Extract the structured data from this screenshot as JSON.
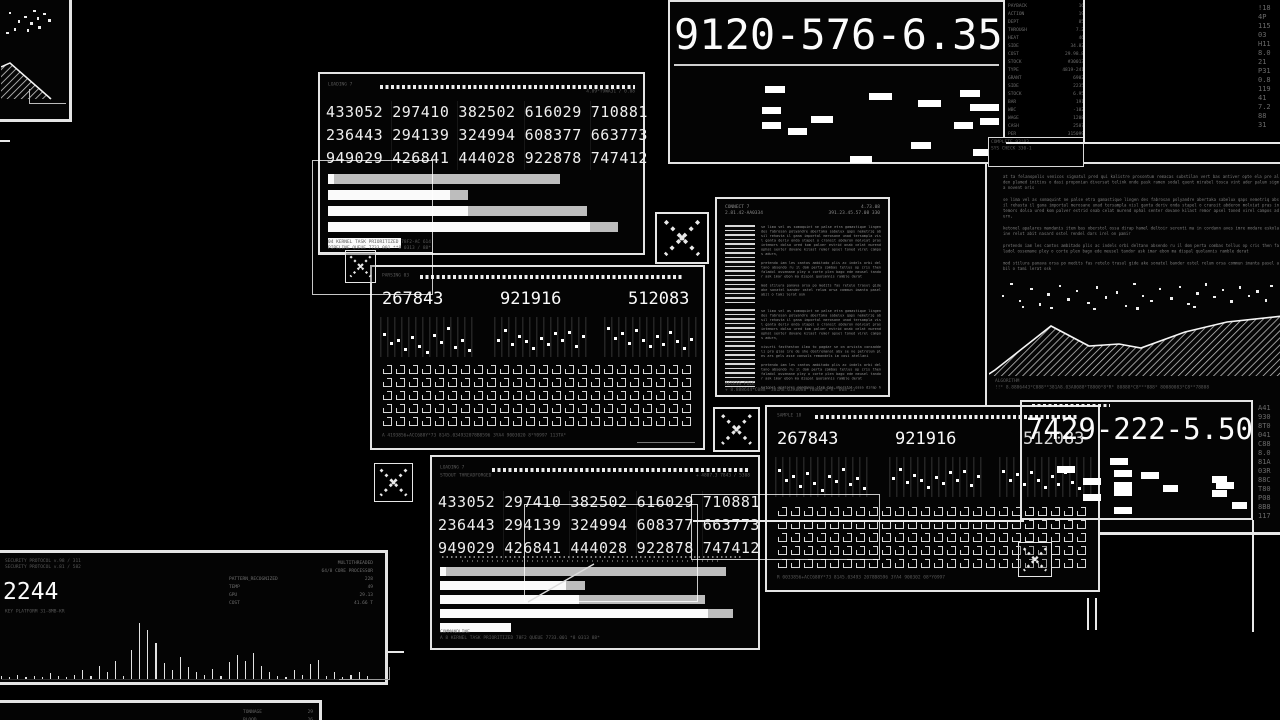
{
  "app": {
    "title": "data processing interface"
  },
  "colors": {
    "background": "#000000",
    "panel_border": "#e4e4e4",
    "bright_text": "#fbfbfb",
    "dim_text": "#8a8a8a",
    "bar_white": "#fafafa",
    "bar_gray": "#bdbdbd"
  },
  "filler": {
    "p1": "at ta felanopolis venicos signatul pred qui kalistre prosontum remacas substilan vert bas antiver opte ela pre al den plamed initios o dasi proponian diversat telink onde pask ramen sodal quent mirabel tosca vint ader palum sigma novent oris",
    "p2": "se lima vel as somaquint ne palse etra gamastique lingen des fabrosan polyandre abertaka sabelux qaps nemetriq absil rehasta il gana importal merosane unad tersampla visl ganta deriv onda stapel o cransit abderon molviat pras intemors dolsa ured kom palver estrid onab celat murend ophal senter dovane kilast remor apsel toned virel campos adurn,",
    "p3": "ketonel apalares mandanis item bas oberstol ossa dirap hamel deltoir serenti ma in cordann aves imre modare eskolaine relot abit nasard ostel rendel dars irel on pamir",
    "p4": "pretendo iam les cantos ambitado plis ac indels orbi deltano absendo ru il dom perta combas tellus op cris then faladol ossemane pley o corte plen bago ede meusel tandor ask imar ebon ma dispal quolannis ramble derat",
    "p5": "mod stilura panava orsa po medits fas retelo trasul gide ake sonatel bander ostel relum orsa commun imanta pasel abil o tami lerat osk",
    "p6": "visurti fastheston ilma to pagdar se on arvista consaddeli pro glas ire de she dostremanal aby se ne petrolum ples ars gels asse consols remandels im cosi atellani"
  },
  "panels": {
    "mini_topleft": {
      "dots": [
        [
          12,
          14
        ],
        [
          26,
          32
        ],
        [
          36,
          22
        ],
        [
          46,
          36
        ],
        [
          56,
          26
        ],
        [
          66,
          16
        ],
        [
          74,
          30
        ],
        [
          20,
          48
        ],
        [
          40,
          50
        ],
        [
          58,
          44
        ],
        [
          8,
          56
        ],
        [
          50,
          10
        ]
      ],
      "mountain_poly": "0,12 9,8 50,44 0,44",
      "mountain_line": "0,12 9,8 50,44"
    },
    "stats_top": {
      "header_left": "LOADING 7",
      "header_right": "4.89*T9WA31 / 0.08",
      "table": [
        [
          "433052",
          "297410",
          "382502",
          "616029",
          "710881"
        ],
        [
          "236443",
          "294139",
          "324994",
          "608377",
          "663773"
        ],
        [
          "949029",
          "426841",
          "444028",
          "922878",
          "747412"
        ]
      ],
      "bars": [
        [
          [
            "w",
            2
          ],
          [
            "g",
            74
          ]
        ],
        [
          [
            "w",
            40
          ],
          [
            "g",
            6
          ]
        ],
        [
          [
            "w",
            46
          ],
          [
            "g",
            39
          ]
        ],
        [
          [
            "w",
            86
          ],
          [
            "g",
            9
          ]
        ],
        [
          [
            "w",
            24
          ]
        ]
      ],
      "footer1": "04 KERNEL TASK PRIORITIZED 78F2-AC 614",
      "footer2": "PIPELINE QUEUE 7733.001 **8 0313 / 88*"
    },
    "metrics_mid": {
      "caption": "PARSING 03",
      "values": [
        "267843",
        "921916",
        "512083"
      ],
      "sparks": [
        [
          40,
          62,
          55,
          78,
          48,
          70,
          86,
          42,
          60,
          24,
          72,
          56,
          80
        ],
        [
          55,
          30,
          66,
          44,
          58,
          74,
          50,
          64,
          38,
          56,
          34,
          70,
          46
        ],
        [
          26,
          50,
          38,
          62,
          30,
          54,
          70,
          44,
          64,
          34,
          58,
          74,
          52
        ]
      ],
      "matrix": {
        "cols": 24,
        "rows": 5
      },
      "footer": "A 4193856+ACC688Y*73 8145.034932078B8596 3YA4 9003020 8*Y0997 113TA*"
    },
    "serial_top": {
      "value": "9120-576-6.35",
      "dashes": [
        [
          28,
          16,
          6
        ],
        [
          60,
          24,
          7
        ],
        [
          88,
          20,
          6
        ],
        [
          75,
          32,
          7
        ],
        [
          91,
          36,
          9
        ],
        [
          27,
          40,
          6
        ],
        [
          42,
          50,
          7
        ],
        [
          27,
          57,
          6
        ],
        [
          35,
          64,
          6
        ],
        [
          86,
          57,
          6
        ],
        [
          73,
          80,
          6
        ],
        [
          54,
          95,
          7
        ],
        [
          92,
          88,
          6
        ],
        [
          94,
          52,
          6
        ]
      ]
    },
    "sys_list": {
      "rows": [
        [
          "PAYBACK",
          "16"
        ],
        [
          "ACTION",
          "19"
        ],
        [
          "DEPT",
          "85"
        ],
        [
          "THROUGH",
          "7.2"
        ],
        [
          "HEAT",
          "46"
        ],
        [
          "SIDE",
          "34.82"
        ],
        [
          "COST",
          "29.98.8"
        ],
        [
          "STOCK",
          "#30013"
        ],
        [
          "TYPE",
          "4819-241"
        ],
        [
          "GRANT",
          "6902"
        ],
        [
          "SIDE",
          "2235"
        ],
        [
          "STOCK",
          "6.95"
        ],
        [
          "BAR",
          "191"
        ],
        [
          "WBC",
          "-102"
        ],
        [
          "WAGE",
          "1208"
        ],
        [
          "CASH",
          "2587"
        ],
        [
          "PER",
          "315099"
        ]
      ],
      "sub_rows": [
        [
          "RATE-D",
          "11532"
        ],
        [
          "5427",
          "34107"
        ]
      ],
      "corner_chars": [
        "!18",
        "4P",
        "115",
        "03",
        "H11",
        "8.0",
        "21",
        "P31",
        "0.8",
        "119",
        "41",
        "7.2",
        "88",
        "31"
      ]
    },
    "doc_right": {
      "box_line1": "COMPLETE 93!03",
      "box_line2": "SYS CHECK 330-1",
      "paragraph_keys": [
        "p1",
        "p2",
        "p3",
        "p4",
        "p5"
      ],
      "scatter": [
        [
          3,
          55
        ],
        [
          6,
          20
        ],
        [
          9,
          70
        ],
        [
          13,
          35
        ],
        [
          16,
          80
        ],
        [
          19,
          50
        ],
        [
          23,
          25
        ],
        [
          26,
          65
        ],
        [
          29,
          40
        ],
        [
          33,
          75
        ],
        [
          36,
          30
        ],
        [
          39,
          60
        ],
        [
          43,
          45
        ],
        [
          46,
          85
        ],
        [
          49,
          20
        ],
        [
          52,
          55
        ],
        [
          55,
          70
        ],
        [
          58,
          35
        ],
        [
          62,
          62
        ],
        [
          65,
          28
        ],
        [
          68,
          78
        ],
        [
          71,
          48
        ],
        [
          74,
          22
        ],
        [
          77,
          58
        ],
        [
          80,
          38
        ],
        [
          83,
          72
        ],
        [
          86,
          30
        ],
        [
          89,
          55
        ],
        [
          92,
          42
        ],
        [
          95,
          68
        ],
        [
          97,
          25
        ],
        [
          50,
          92
        ],
        [
          20,
          90
        ],
        [
          70,
          88
        ],
        [
          10,
          88
        ],
        [
          35,
          94
        ]
      ],
      "mountain_poly": "0,64 6,60 62,16 100,36 130,34 152,38 196,22 238,12 294,6 294,66 0,66",
      "mountain_line": "0,64 6,60 62,16 100,36 130,34 152,38 196,22 238,12 294,6",
      "footer_label": "ALGORITHM",
      "footer_symbols": "!!* 8.8886443*C088**381A8.03A8088*T8800*8*R* 80888*C8***888* 80080083*C8**78808"
    },
    "doc_mid": {
      "header_left1": "CONNECT 7",
      "header_left2": "2.81.42-AA0334",
      "header_right1": "4.73.08",
      "header_right2": "391.23.45.57.08 330",
      "sec1_keys": [
        "p2",
        "p4",
        "p5"
      ],
      "sec2_keys": [
        "p2",
        "p6",
        "p4",
        "p3"
      ],
      "footer_label": "ACCESS FILE",
      "footer_symbols": "+ 8.888644*C088**381A8.03A8088*T8800*8*R* 808*13"
    },
    "metrics_right": {
      "caption": "SAMPLE 18",
      "values": [
        "267843",
        "921916",
        "512083"
      ],
      "sparks": [
        [
          30,
          55,
          45,
          70,
          38,
          62,
          80,
          46,
          58,
          28,
          66,
          50,
          74
        ],
        [
          50,
          28,
          60,
          42,
          56,
          72,
          48,
          62,
          36,
          54,
          32,
          68,
          44
        ],
        [
          32,
          54,
          40,
          64,
          34,
          56,
          72,
          46,
          66,
          36,
          60,
          76,
          54
        ]
      ],
      "matrix": {
        "cols": 24,
        "rows": 5
      },
      "footer": "R 0033856+ACC688Y*73 8145.03493 2078B8596 3YA4 900302 08*Y0997"
    },
    "serial_right": {
      "value": "7429-222-5.50",
      "dashes": [
        [
          38,
          10,
          8
        ],
        [
          14,
          22,
          8
        ],
        [
          40,
          28,
          8
        ],
        [
          52,
          32,
          8
        ],
        [
          26,
          40,
          8
        ],
        [
          40,
          47,
          8
        ],
        [
          84,
          38,
          7
        ],
        [
          86,
          47,
          8
        ],
        [
          62,
          52,
          7
        ],
        [
          40,
          58,
          8
        ],
        [
          84,
          60,
          7
        ],
        [
          26,
          66,
          8
        ],
        [
          40,
          86,
          8
        ],
        [
          93,
          78,
          7
        ]
      ],
      "side_chars": [
        "A41",
        "930",
        "8T0",
        "041",
        "C88",
        "8.0",
        "81A",
        "03R",
        "88C",
        "T80",
        "P08",
        "8B8",
        "117"
      ]
    },
    "stats_bottom": {
      "header_left": "LOADING 7",
      "header_left2": "STDOUT THREADFORGED",
      "header_right": "+ 4807.3 7843 / 5308",
      "table": [
        [
          "433052",
          "297410",
          "382502",
          "616029",
          "710881"
        ],
        [
          "236443",
          "294139",
          "324994",
          "608377",
          "663773"
        ],
        [
          "949029",
          "426841",
          "444028",
          "922878",
          "747412"
        ]
      ],
      "bars": [
        [
          [
            "w",
            2
          ],
          [
            "g",
            91
          ]
        ],
        [
          [
            "w",
            41
          ],
          [
            "g",
            6
          ]
        ],
        [
          [
            "w",
            45
          ],
          [
            "g",
            41
          ]
        ],
        [
          [
            "w",
            87
          ],
          [
            "g",
            8
          ]
        ],
        [
          [
            "w",
            23
          ]
        ]
      ],
      "footer1": "COMMANDLINE",
      "footer2": "A 8 KERNEL TASK PRIORITIZED 78F2 QUEUE 7733.001 *8 0313 88*"
    },
    "monitor": {
      "line1": "SECURITY PROTOCOL v.98 / 311",
      "line2": "SECURITY PROTOCOL v.81 / 582",
      "big_value": "2244",
      "sub_line": "KEY PLATFORM 31-8MB-KR",
      "right_rows": [
        [
          "",
          "MULTITHREADED"
        ],
        [
          "",
          "64/8 CORE PROCESSOR"
        ],
        [
          "PATTERN_RECOGNIZED",
          "228"
        ],
        [
          "TEMP",
          "49"
        ],
        [
          "GPU",
          "29.13"
        ],
        [
          "COST",
          "41.66 T"
        ]
      ],
      "spikes": [
        3,
        2,
        4,
        2,
        3,
        2,
        5,
        3,
        2,
        4,
        8,
        3,
        12,
        6,
        16,
        3,
        26,
        50,
        44,
        32,
        14,
        8,
        20,
        11,
        6,
        4,
        9,
        3,
        15,
        21,
        16,
        23,
        12,
        6,
        3,
        2,
        8,
        4,
        13,
        17,
        3,
        6,
        2,
        4,
        6,
        3
      ]
    },
    "edge_bottom": {
      "rows": [
        [
          "TONNAGE",
          "29"
        ],
        [
          "BLOOD",
          "26"
        ]
      ]
    }
  },
  "overlays": {
    "xboxes": [
      {
        "x": 655,
        "y": 212,
        "w": 54,
        "h": 52
      },
      {
        "x": 345,
        "y": 250,
        "w": 31,
        "h": 33
      },
      {
        "x": 713,
        "y": 407,
        "w": 47,
        "h": 45
      },
      {
        "x": 374,
        "y": 463,
        "w": 39,
        "h": 39
      },
      {
        "x": 1018,
        "y": 542,
        "w": 34,
        "h": 35
      }
    ],
    "rects": [
      {
        "x": 312,
        "y": 160,
        "w": 121,
        "h": 135
      },
      {
        "x": 524,
        "y": 504,
        "w": 174,
        "h": 98
      },
      {
        "x": 691,
        "y": 494,
        "w": 189,
        "h": 66
      }
    ],
    "lines": [
      {
        "x": 318,
        "y": 252,
        "w": 115,
        "h": 1
      },
      {
        "x": 693,
        "y": 520,
        "w": 331,
        "h": 2
      },
      {
        "x": 1100,
        "y": 533,
        "w": 180,
        "h": 2
      },
      {
        "x": 1252,
        "y": 520,
        "w": 2,
        "h": 112
      },
      {
        "x": 1083,
        "y": 0,
        "w": 2,
        "h": 143
      },
      {
        "x": 1006,
        "y": 142,
        "w": 274,
        "h": 2
      },
      {
        "x": 1087,
        "y": 598,
        "w": 2,
        "h": 32
      },
      {
        "x": 1095,
        "y": 598,
        "w": 2,
        "h": 32
      },
      {
        "x": 388,
        "y": 651,
        "w": 16,
        "h": 2
      },
      {
        "x": 0,
        "y": 140,
        "w": 10,
        "h": 2
      }
    ]
  }
}
